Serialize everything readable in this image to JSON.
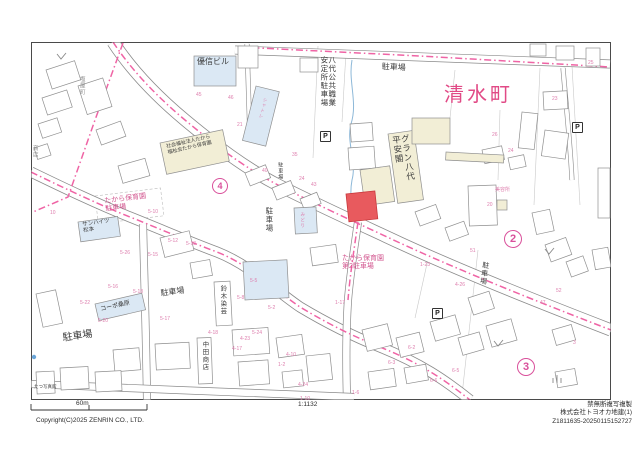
{
  "colors": {
    "road_centerline": "#ef64a5",
    "boundary_line": "#ef64a5",
    "town_name": "#e14a86",
    "lot_number": "#de7fae",
    "parcel_highlight": "#e85a5e",
    "parcel_highlight_border": "#c9393d",
    "building_blue": "#dbe8f4",
    "building_yellow": "#f2eed6",
    "circled_number": "#d9509b",
    "dark": "#3a3a3a",
    "pink": "#d2568f",
    "gray": "#8a8a8a",
    "lot": "#de7fae",
    "town": "#e14a86"
  },
  "map": {
    "labels": [
      {
        "name": "label-town-shimizumachi",
        "text": "清水町",
        "x": 444,
        "y": 84,
        "size": 20,
        "color": "town",
        "vertical": false,
        "rot": 0,
        "spacing": 3
      },
      {
        "name": "label-yushin-building",
        "text": "優信ビル",
        "x": 197,
        "y": 57,
        "size": 8,
        "color": "dark",
        "vertical": false,
        "rot": 0
      },
      {
        "name": "label-chatre",
        "text": "シャトレ",
        "x": 263,
        "y": 97,
        "size": 4.5,
        "color": "lot",
        "vertical": true,
        "rot": 14
      },
      {
        "name": "label-hello-work-parking",
        "text": "八代公共職業\n安定所駐車場",
        "x": 320,
        "y": 56,
        "size": 7.5,
        "color": "dark",
        "vertical": true,
        "rot": 0
      },
      {
        "name": "label-parking-top",
        "text": "駐車場",
        "x": 382,
        "y": 62,
        "size": 8,
        "color": "dark",
        "vertical": false,
        "rot": 3
      },
      {
        "name": "label-guran-heiankaku",
        "text": "グラン八代\n平安閣",
        "x": 391,
        "y": 136,
        "size": 8.5,
        "color": "dark",
        "vertical": true,
        "rot": -8
      },
      {
        "name": "label-welfare-corp-takara",
        "text": "社会福祉法人たから\n福祉会たから保育園",
        "x": 166,
        "y": 145,
        "size": 5,
        "color": "dark",
        "vertical": false,
        "rot": -13
      },
      {
        "name": "label-takara-hoikuen-parking",
        "text": "たから保育園\n駐車場",
        "x": 104,
        "y": 198,
        "size": 7,
        "color": "pink",
        "vertical": false,
        "rot": -7
      },
      {
        "name": "label-sunheights-matsumoto",
        "text": "サンハイツ\n松本",
        "x": 82,
        "y": 222,
        "size": 5.5,
        "color": "dark",
        "vertical": false,
        "rot": -8
      },
      {
        "name": "label-parking-center-vertical",
        "text": "駐車場",
        "x": 265,
        "y": 207,
        "size": 7.5,
        "color": "dark",
        "vertical": true,
        "rot": 0
      },
      {
        "name": "label-parking-small-vertical",
        "text": "駐車場",
        "x": 277,
        "y": 162,
        "size": 5,
        "color": "dark",
        "vertical": true,
        "rot": 0
      },
      {
        "name": "label-midori",
        "text": "みどり",
        "x": 300,
        "y": 212,
        "size": 4.5,
        "color": "lot",
        "vertical": true,
        "rot": 0
      },
      {
        "name": "label-parking-mid",
        "text": "駐車場",
        "x": 160,
        "y": 289,
        "size": 8,
        "color": "dark",
        "vertical": false,
        "rot": -8
      },
      {
        "name": "label-parking-left",
        "text": "駐車場",
        "x": 62,
        "y": 333,
        "size": 10,
        "color": "dark",
        "vertical": false,
        "rot": -8
      },
      {
        "name": "label-copo-kuwahara",
        "text": "コーポ桑原",
        "x": 100,
        "y": 307,
        "size": 6,
        "color": "dark",
        "vertical": false,
        "rot": -13
      },
      {
        "name": "label-suzuki-sengei",
        "text": "鈴木染芸",
        "x": 218,
        "y": 285,
        "size": 6.5,
        "color": "dark",
        "vertical": true,
        "rot": 0
      },
      {
        "name": "label-nakata-shoten",
        "text": "中田商店",
        "x": 200,
        "y": 341,
        "size": 6.5,
        "color": "dark",
        "vertical": true,
        "rot": 0
      },
      {
        "name": "label-takara-hoikuen-parking2",
        "text": "たから保育園\n第2駐車場",
        "x": 342,
        "y": 255,
        "size": 7,
        "color": "pink",
        "vertical": false,
        "rot": 0
      },
      {
        "name": "label-parking-right-vertical",
        "text": "駐車場",
        "x": 482,
        "y": 261,
        "size": 7,
        "color": "dark",
        "vertical": true,
        "rot": 8
      },
      {
        "name": "label-biyosho",
        "text": "美容所",
        "x": 495,
        "y": 188,
        "size": 5,
        "color": "lot",
        "vertical": false,
        "rot": 0
      },
      {
        "name": "label-shioyamachi",
        "text": "塩屋町",
        "x": 78,
        "y": 76,
        "size": 5.5,
        "color": "gray",
        "vertical": true,
        "rot": 0
      },
      {
        "name": "label-shoten-left-edge",
        "text": "商店",
        "x": 31,
        "y": 145,
        "size": 5.5,
        "color": "gray",
        "vertical": true,
        "rot": 0
      },
      {
        "name": "label-photo-studio",
        "text": "たつ写真館",
        "x": 34,
        "y": 384,
        "size": 4.5,
        "color": "dark",
        "vertical": false,
        "rot": 0
      }
    ],
    "lot_numbers": [
      {
        "t": "45",
        "x": 196,
        "y": 92
      },
      {
        "t": "46",
        "x": 228,
        "y": 95
      },
      {
        "t": "21",
        "x": 237,
        "y": 122
      },
      {
        "t": "40",
        "x": 262,
        "y": 168
      },
      {
        "t": "35",
        "x": 292,
        "y": 152
      },
      {
        "t": "24",
        "x": 299,
        "y": 176
      },
      {
        "t": "43",
        "x": 311,
        "y": 182
      },
      {
        "t": "20",
        "x": 487,
        "y": 202
      },
      {
        "t": "26",
        "x": 492,
        "y": 132
      },
      {
        "t": "24",
        "x": 508,
        "y": 148
      },
      {
        "t": "23",
        "x": 552,
        "y": 96
      },
      {
        "t": "25",
        "x": 588,
        "y": 60
      },
      {
        "t": "51",
        "x": 470,
        "y": 248
      },
      {
        "t": "52",
        "x": 556,
        "y": 288
      },
      {
        "t": "47",
        "x": 540,
        "y": 300
      },
      {
        "t": "5-10",
        "x": 148,
        "y": 209
      },
      {
        "t": "5-12",
        "x": 168,
        "y": 238
      },
      {
        "t": "5-13",
        "x": 186,
        "y": 241
      },
      {
        "t": "5-15",
        "x": 148,
        "y": 252
      },
      {
        "t": "5-26",
        "x": 120,
        "y": 250
      },
      {
        "t": "5-16",
        "x": 108,
        "y": 284
      },
      {
        "t": "5-18",
        "x": 133,
        "y": 289
      },
      {
        "t": "5-17",
        "x": 160,
        "y": 316
      },
      {
        "t": "5-22",
        "x": 80,
        "y": 300
      },
      {
        "t": "5-20",
        "x": 98,
        "y": 318
      },
      {
        "t": "5-5",
        "x": 250,
        "y": 278
      },
      {
        "t": "5-8",
        "x": 237,
        "y": 295
      },
      {
        "t": "5-2",
        "x": 268,
        "y": 305
      },
      {
        "t": "5-24",
        "x": 252,
        "y": 330
      },
      {
        "t": "4-23",
        "x": 240,
        "y": 336
      },
      {
        "t": "4-17",
        "x": 232,
        "y": 346
      },
      {
        "t": "4-18",
        "x": 208,
        "y": 330
      },
      {
        "t": "4-10",
        "x": 286,
        "y": 352
      },
      {
        "t": "4-24",
        "x": 298,
        "y": 382
      },
      {
        "t": "1-17",
        "x": 335,
        "y": 300
      },
      {
        "t": "1-23",
        "x": 420,
        "y": 262
      },
      {
        "t": "4-26",
        "x": 455,
        "y": 282
      },
      {
        "t": "6-3",
        "x": 388,
        "y": 360
      },
      {
        "t": "6-2",
        "x": 408,
        "y": 345
      },
      {
        "t": "6-6",
        "x": 430,
        "y": 378
      },
      {
        "t": "6-5",
        "x": 452,
        "y": 368
      },
      {
        "t": "1-2",
        "x": 278,
        "y": 362
      },
      {
        "t": "1-6",
        "x": 352,
        "y": 390
      },
      {
        "t": "1-10",
        "x": 300,
        "y": 396
      },
      {
        "t": "10",
        "x": 50,
        "y": 210
      },
      {
        "t": "3",
        "x": 573,
        "y": 340
      }
    ],
    "circled_numbers": [
      {
        "value": "4",
        "x": 219,
        "y": 185,
        "d": 14
      },
      {
        "value": "2",
        "x": 512,
        "y": 238,
        "d": 16
      },
      {
        "value": "3",
        "x": 525,
        "y": 366,
        "d": 16
      }
    ],
    "parking_symbols": [
      {
        "glyph": "P",
        "x": 325,
        "y": 136
      },
      {
        "glyph": "P",
        "x": 577,
        "y": 127
      },
      {
        "glyph": "P",
        "x": 437,
        "y": 313
      }
    ]
  },
  "footer": {
    "scale_label": "60m",
    "scale_ratio": "1:1132",
    "copyright": "Copyright(C)2025 ZENRIN CO., LTD.",
    "rights_notice": "禁無断複写複製",
    "company_line": "株式会社トヨオカ地建(1)",
    "print_code": "Z1811635-20250115152727"
  }
}
